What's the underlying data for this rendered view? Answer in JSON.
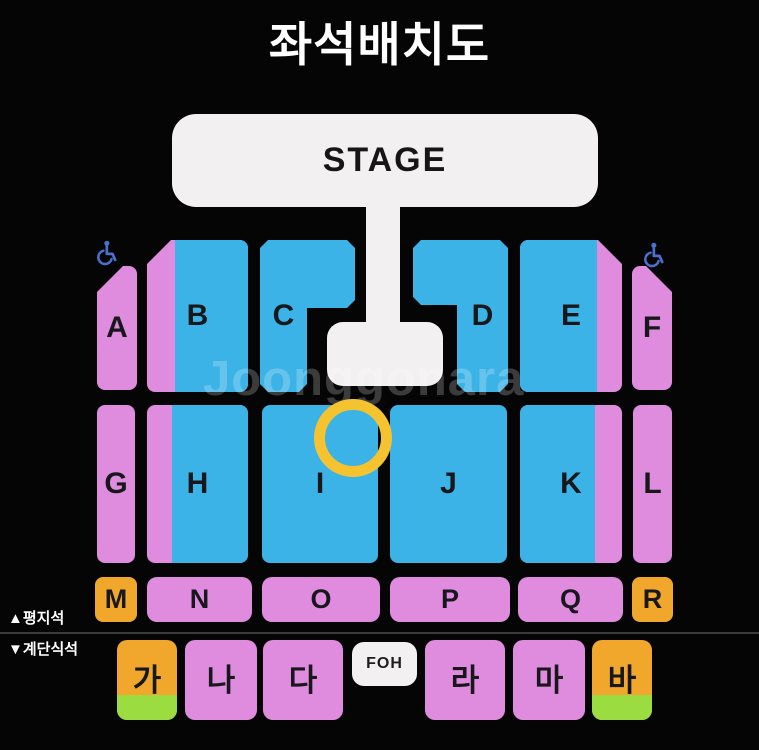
{
  "title": "좌석배치도",
  "stage": {
    "label": "STAGE"
  },
  "watermark": "Joonggonara",
  "legend": {
    "flat_seats": "▲평지석",
    "stair_seats": "▼계단식석"
  },
  "foh": {
    "label": "FOH"
  },
  "icons": {
    "wheelchair_left": "wheelchair-icon",
    "wheelchair_right": "wheelchair-icon"
  },
  "annotation": {
    "highlight_ring": "yellow ring over top of section I"
  },
  "colors": {
    "background": "#050505",
    "blue_seat": "#3BB3E6",
    "pink_seat": "#DF8CDF",
    "orange_seat": "#F0A72B",
    "green_stripe": "#9BDC40",
    "highlight_ring": "#F5C32F",
    "stage_fill": "#F2F0F0",
    "wheelchair_icon": "#4B70CE",
    "title_text": "#FFFFFF"
  },
  "sections": {
    "row1": [
      {
        "label": "A"
      },
      {
        "label": "B"
      },
      {
        "label": "C"
      },
      {
        "label": "D"
      },
      {
        "label": "E"
      },
      {
        "label": "F"
      }
    ],
    "row2": [
      {
        "label": "G"
      },
      {
        "label": "H"
      },
      {
        "label": "I"
      },
      {
        "label": "J"
      },
      {
        "label": "K"
      },
      {
        "label": "L"
      }
    ],
    "row3": [
      {
        "label": "M"
      },
      {
        "label": "N"
      },
      {
        "label": "O"
      },
      {
        "label": "P"
      },
      {
        "label": "Q"
      },
      {
        "label": "R"
      }
    ],
    "row4": [
      {
        "label": "가"
      },
      {
        "label": "나"
      },
      {
        "label": "다"
      },
      {
        "label": "라"
      },
      {
        "label": "마"
      },
      {
        "label": "바"
      }
    ]
  }
}
